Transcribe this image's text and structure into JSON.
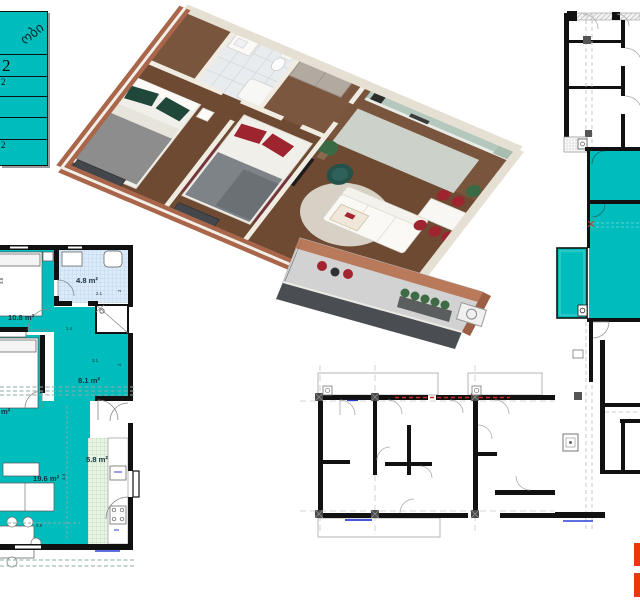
{
  "sheet": {
    "type": "apartment-floorplan-sheet",
    "background": "#ffffff"
  },
  "colors": {
    "highlight_teal": "#00bdbd",
    "wall_black": "#111111",
    "tile_blue": "#dcebf9",
    "tile_green": "#eaf5e7",
    "grid_gray": "#c6c6c6",
    "red_dashed_line": "#cc2b1f",
    "window_blue": "#2b3fd6",
    "logo_red": "#e8380d",
    "brick": "#a9664a",
    "wood_floor": "#6e4a33",
    "kitchen_sage": "#b5c8bd",
    "accent_red": "#9e2430",
    "accent_green": "#1f4638"
  },
  "legend": {
    "header_text": "ობი",
    "rows": [
      "2",
      "2",
      "",
      "",
      "2"
    ]
  },
  "left_plan": {
    "rooms": [
      {
        "id": "bedroom-1",
        "area": "10.8 m²"
      },
      {
        "id": "bathroom",
        "area": "4.8 m²"
      },
      {
        "id": "hall",
        "area": "8.1 m²"
      },
      {
        "id": "bedroom-2",
        "area": "m²"
      },
      {
        "id": "living-room",
        "area": "19.6 m²"
      },
      {
        "id": "kitchen",
        "area": "5.8 m²"
      }
    ],
    "dims": [
      "3.8",
      "2.1",
      "2",
      "1.4",
      "3.1",
      "2",
      "4.4",
      "3.8"
    ]
  },
  "render_3d": {
    "description": "isometric 3d apartment render"
  },
  "right_plan": {
    "description": "building level plan, unit highlighted teal"
  },
  "bottom_plan": {
    "description": "adjacent units construction plan"
  }
}
